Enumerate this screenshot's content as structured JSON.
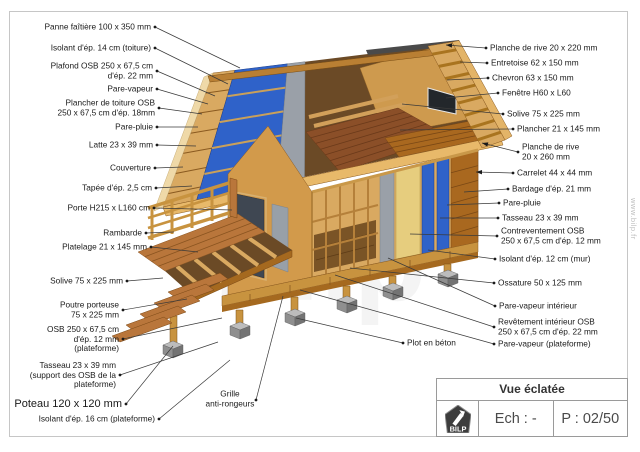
{
  "page": {
    "side_watermark": "www.bilp.fr",
    "center_watermark": "bilp"
  },
  "title_block": {
    "title": "Vue éclatée",
    "logo_text": "BILP",
    "scale_label": "Ech : -",
    "page_label": "P : 02/50"
  },
  "colors": {
    "insulation_blue": "#2f62c9",
    "wood_light": "#d9a961",
    "wood_dark": "#a9681f",
    "concrete_gray": "#8f8f8f"
  },
  "labels": [
    {
      "name": "panne-faitiere",
      "lines": [
        "Panne faîtière 100 x 350 mm"
      ],
      "align": "right",
      "x": 155,
      "y": 27,
      "tx": 240,
      "ty": 68
    },
    {
      "name": "isolant-toiture",
      "lines": [
        "Isolant d'ép. 14 cm (toiture)"
      ],
      "align": "right",
      "x": 155,
      "y": 48,
      "tx": 228,
      "ty": 84
    },
    {
      "name": "plafond-osb",
      "lines": [
        "Plafond OSB 250 x 67,5 cm",
        "d'ép. 22 mm"
      ],
      "align": "right",
      "x": 157,
      "y": 71,
      "tx": 215,
      "ty": 96
    },
    {
      "name": "pare-vapeur-toiture",
      "lines": [
        "Pare-vapeur"
      ],
      "align": "right",
      "x": 157,
      "y": 89,
      "tx": 208,
      "ty": 104
    },
    {
      "name": "plancher-toiture-osb",
      "lines": [
        "Plancher de toiture OSB",
        "250 x 67,5 cm d'ép. 18mm"
      ],
      "align": "right",
      "x": 159,
      "y": 108,
      "tx": 202,
      "ty": 114
    },
    {
      "name": "pare-pluie-toiture",
      "lines": [
        "Pare-pluie"
      ],
      "align": "right",
      "x": 157,
      "y": 127,
      "tx": 198,
      "ty": 127
    },
    {
      "name": "latte",
      "lines": [
        "Latte 23 x 39 mm"
      ],
      "align": "right",
      "x": 157,
      "y": 145,
      "tx": 196,
      "ty": 146
    },
    {
      "name": "couverture",
      "lines": [
        "Couverture"
      ],
      "align": "right",
      "x": 155,
      "y": 168,
      "tx": 183,
      "ty": 167
    },
    {
      "name": "tapee",
      "lines": [
        "Tapée d'ép. 2,5 cm"
      ],
      "align": "right",
      "x": 156,
      "y": 188,
      "tx": 192,
      "ty": 186
    },
    {
      "name": "porte",
      "lines": [
        "Porte H215 x L160 cm"
      ],
      "align": "right",
      "x": 154,
      "y": 208,
      "tx": 232,
      "ty": 210
    },
    {
      "name": "rambarde",
      "lines": [
        "Rambarde"
      ],
      "align": "right",
      "x": 146,
      "y": 233,
      "tx": 174,
      "ty": 232
    },
    {
      "name": "platelage",
      "lines": [
        "Platelage 21 x 145 mm"
      ],
      "align": "right",
      "x": 151,
      "y": 247,
      "tx": 198,
      "ty": 252
    },
    {
      "name": "solive-terrasse",
      "lines": [
        "Solive 75 x 225 mm"
      ],
      "align": "right",
      "x": 127,
      "y": 281,
      "tx": 163,
      "ty": 278
    },
    {
      "name": "poutre-porteuse",
      "lines": [
        "Poutre porteuse",
        "75 x 225 mm"
      ],
      "align": "right",
      "x": 123,
      "y": 310,
      "tx": 187,
      "ty": 299
    },
    {
      "name": "osb-plateforme",
      "lines": [
        "OSB 250 x 67,5 cm",
        "d'ép. 12 mm",
        "(plateforme)"
      ],
      "align": "right",
      "x": 123,
      "y": 339,
      "tx": 222,
      "ty": 318
    },
    {
      "name": "tasseau-plateforme",
      "lines": [
        "Tasseau 23 x 39 mm",
        "(support des OSB de la",
        "plateforme)"
      ],
      "align": "right",
      "x": 120,
      "y": 375,
      "tx": 218,
      "ty": 342
    },
    {
      "name": "poteau",
      "lines": [
        "Poteau 120 x 120 mm"
      ],
      "align": "right",
      "x": 126,
      "y": 404,
      "tx": 173,
      "ty": 346,
      "size": 11
    },
    {
      "name": "isolant-plateforme",
      "lines": [
        "Isolant d'ép. 16 cm (plateforme)"
      ],
      "align": "right",
      "x": 159,
      "y": 419,
      "tx": 230,
      "ty": 360
    },
    {
      "name": "planche-rive-220",
      "lines": [
        "Planche de rive 20 x 220 mm"
      ],
      "align": "left",
      "x": 486,
      "y": 48,
      "tx": 446,
      "ty": 45,
      "arrow": true
    },
    {
      "name": "entretoise",
      "lines": [
        "Entretoise 62 x 150 mm"
      ],
      "align": "left",
      "x": 487,
      "y": 63,
      "tx": 460,
      "ty": 62
    },
    {
      "name": "chevron",
      "lines": [
        "Chevron 63 x 150 mm"
      ],
      "align": "left",
      "x": 488,
      "y": 78,
      "tx": 447,
      "ty": 80
    },
    {
      "name": "fenetre",
      "lines": [
        "Fenêtre H60 x L60"
      ],
      "align": "left",
      "x": 498,
      "y": 93,
      "tx": 446,
      "ty": 98
    },
    {
      "name": "solive-plancher",
      "lines": [
        "Solive 75 x 225 mm"
      ],
      "align": "left",
      "x": 503,
      "y": 114,
      "tx": 402,
      "ty": 104
    },
    {
      "name": "plancher",
      "lines": [
        "Plancher 21 x 145 mm"
      ],
      "align": "left",
      "x": 513,
      "y": 129,
      "tx": 400,
      "ty": 130
    },
    {
      "name": "planche-rive-260",
      "lines": [
        "Planche de rive",
        "20 x 260 mm"
      ],
      "align": "left",
      "x": 518,
      "y": 152,
      "tx": 482,
      "ty": 143,
      "arrow": true
    },
    {
      "name": "carrelet",
      "lines": [
        "Carrelet 44 x 44 mm"
      ],
      "align": "left",
      "x": 513,
      "y": 173,
      "tx": 476,
      "ty": 172,
      "arrow": true
    },
    {
      "name": "bardage",
      "lines": [
        "Bardage d'ép. 21 mm"
      ],
      "align": "left",
      "x": 508,
      "y": 189,
      "tx": 464,
      "ty": 192
    },
    {
      "name": "pare-pluie-mur",
      "lines": [
        "Pare-pluie"
      ],
      "align": "left",
      "x": 499,
      "y": 203,
      "tx": 447,
      "ty": 205
    },
    {
      "name": "tasseau-mur",
      "lines": [
        "Tasseau 23 x 39 mm"
      ],
      "align": "left",
      "x": 498,
      "y": 218,
      "tx": 440,
      "ty": 218
    },
    {
      "name": "contreventement",
      "lines": [
        "Contreventement OSB",
        "250 x 67,5 cm d'ép. 12 mm"
      ],
      "align": "left",
      "x": 497,
      "y": 236,
      "tx": 410,
      "ty": 234
    },
    {
      "name": "isolant-mur",
      "lines": [
        "Isolant d'ép. 12 cm (mur)"
      ],
      "align": "left",
      "x": 495,
      "y": 259,
      "tx": 428,
      "ty": 250
    },
    {
      "name": "ossature",
      "lines": [
        "Ossature 50 x 125 mm"
      ],
      "align": "left",
      "x": 494,
      "y": 283,
      "tx": 350,
      "ty": 268
    },
    {
      "name": "pare-vapeur-interieur",
      "lines": [
        "Pare-vapeur intérieur"
      ],
      "align": "left",
      "x": 495,
      "y": 306,
      "tx": 388,
      "ty": 258
    },
    {
      "name": "revetement-interieur",
      "lines": [
        "Revêtement intérieur OSB",
        "250 x 67,5 cm d'ép. 22 mm"
      ],
      "align": "left",
      "x": 494,
      "y": 327,
      "tx": 335,
      "ty": 275
    },
    {
      "name": "pare-vapeur-plateforme",
      "lines": [
        "Pare-vapeur (plateforme)"
      ],
      "align": "left",
      "x": 494,
      "y": 344,
      "tx": 300,
      "ty": 290
    },
    {
      "name": "plot-beton",
      "lines": [
        "Plot en béton"
      ],
      "align": "left",
      "x": 403,
      "y": 343,
      "tx": 296,
      "ty": 318
    },
    {
      "name": "grille",
      "lines": [
        "Grille",
        "anti-rongeurs"
      ],
      "align": "center",
      "x": 230,
      "y": 399,
      "dx": 256,
      "dy": 400,
      "tx": 283,
      "ty": 296
    }
  ]
}
